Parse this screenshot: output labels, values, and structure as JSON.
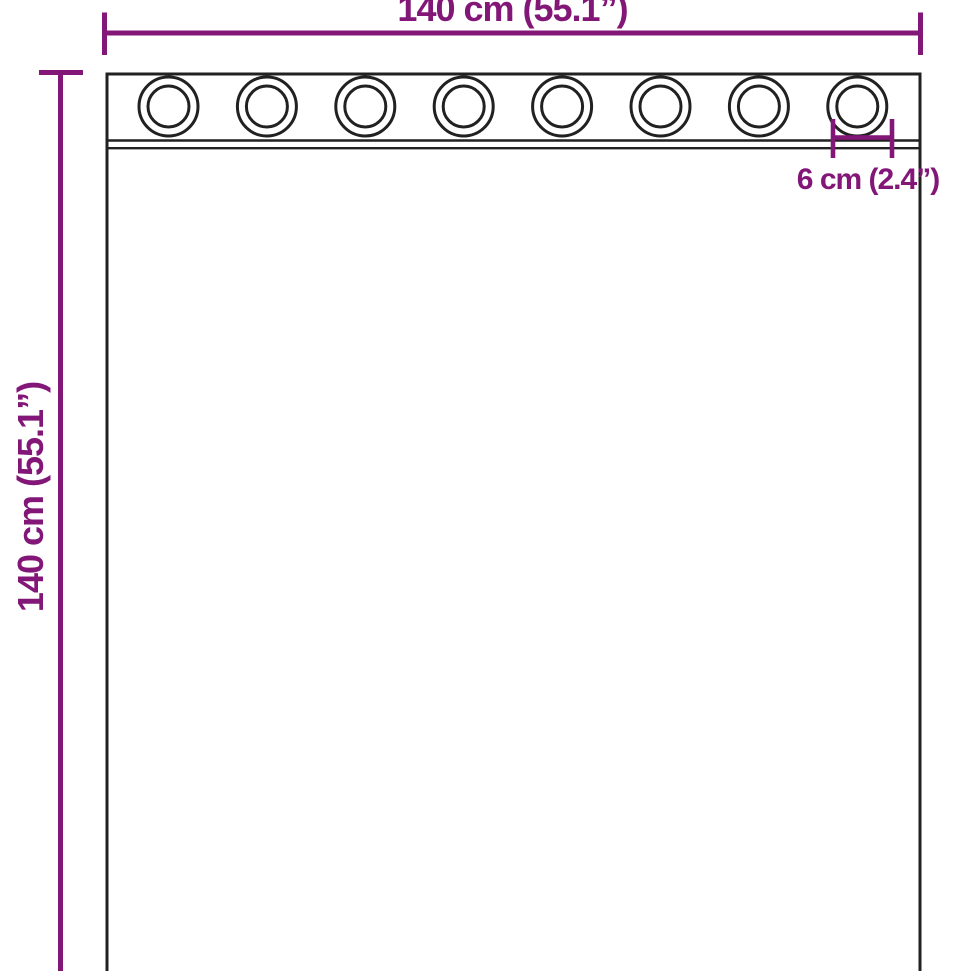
{
  "diagram": {
    "width_dimension": {
      "label": "140 cm (55.1”)"
    },
    "height_dimension": {
      "label": "140 cm (55.1”)"
    },
    "grommet_dimension": {
      "label": "6 cm (2.4”)"
    },
    "grommet_count": 8,
    "colors": {
      "accent": "#821778",
      "outline": "#212121",
      "background": "#ffffff"
    }
  }
}
